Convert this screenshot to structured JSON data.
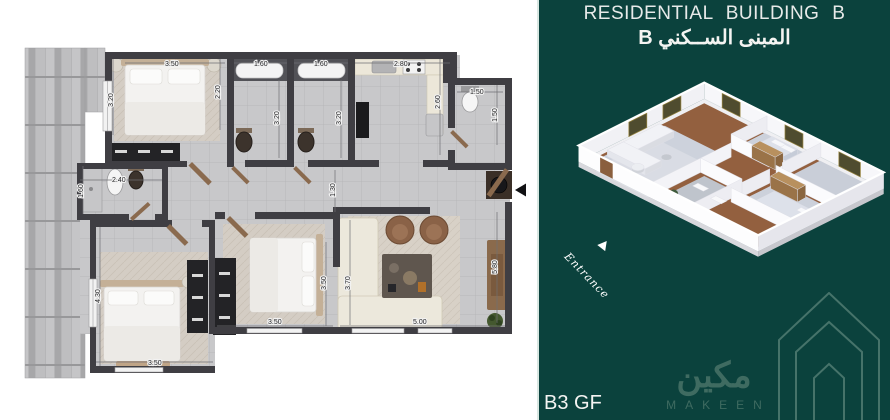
{
  "panel": {
    "bg_color": "#0b423d",
    "edge_line_color": "#d9e7e2",
    "title": "RESIDENTIAL BUILDING B",
    "title_ar": "المبنى الســكني B",
    "unit_label": "B3 GF",
    "entrance_label": "Entrance"
  },
  "logo": {
    "arabic": "مكين",
    "latin": "MAKEEN",
    "color": "#3f6b61"
  },
  "plan": {
    "wall_color": "#3f3e43",
    "dims": {
      "bed1_w": "3.50",
      "bed1_h": "3.20",
      "bed1_h2": "2.20",
      "bath1_w": "1.60",
      "bath1_h": "3.20",
      "bath2_w": "1.60",
      "bath2_h": "3.20",
      "kitchen_w": "2.80",
      "kitchen_h": "2.60",
      "bath3_w": "1.50",
      "bath3_h": "1.50",
      "bath4_w": "2.40",
      "bath4_h": "1.60",
      "hall_w": "1.30",
      "bed2_h": "4.30",
      "bed2_w": "3.50",
      "bed3_w": "3.50",
      "bed3_h": "3.50",
      "living_h": "3.70",
      "living_w": "5.00",
      "living_h2": "5.80"
    }
  }
}
